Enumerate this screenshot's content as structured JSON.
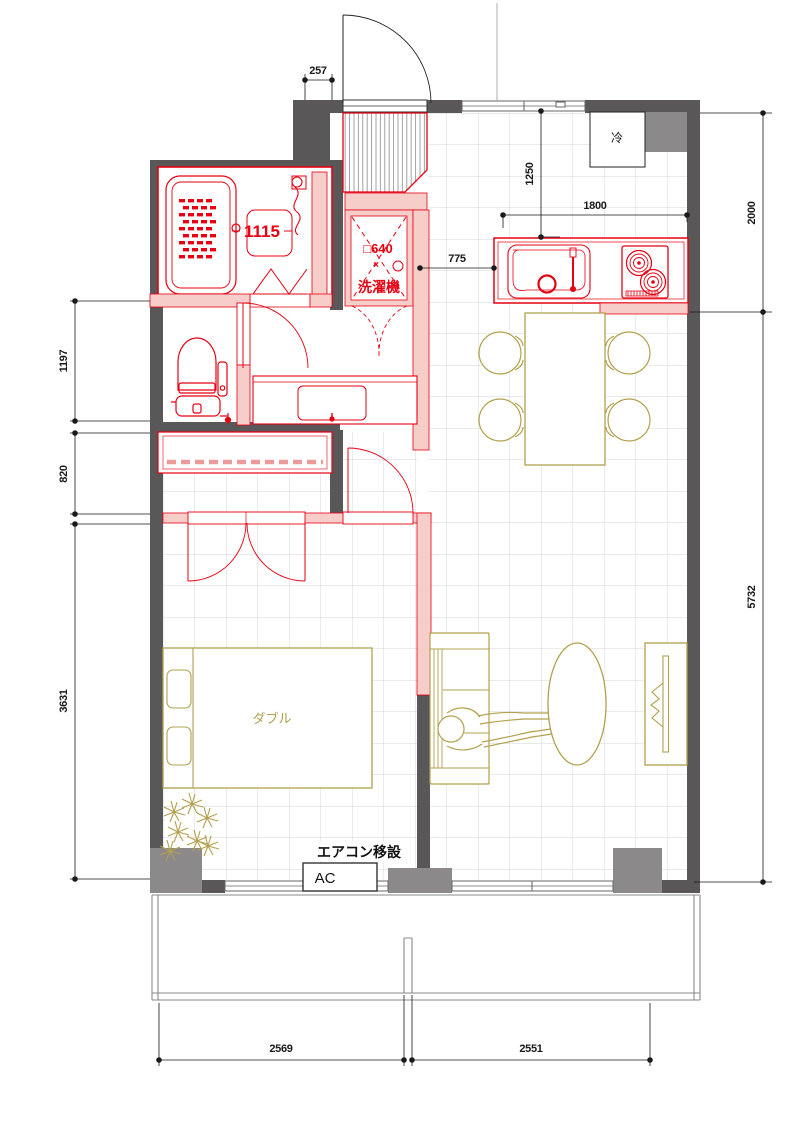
{
  "plan": {
    "title": "apartment-floor-plan",
    "labels": {
      "unit_bath_size": "1115",
      "refrigerator": "冷",
      "washer_size": "□640",
      "washer_times": "×",
      "washer": "洗濯機",
      "bed": "ダブル",
      "ac_note": "エアコン移設",
      "ac": "AC"
    },
    "dimensions": {
      "entry_offset": "257",
      "kitchen_depth": "1250",
      "kitchen_width": "1800",
      "kitchen_zone_height": "2000",
      "passage_width": "775",
      "toilet_zone_height": "1197",
      "closet_zone_height": "820",
      "bedroom_height": "3631",
      "living_height": "5732",
      "balcony_left_width": "2569",
      "balcony_right_width": "2551"
    },
    "colors": {
      "renovation_red": "#e60012",
      "renovation_pink": "#f7cdc9",
      "wall_dark": "#595757",
      "wall_gray": "#8b8989",
      "furniture_tan": "#b2a04e",
      "grid": "#c6c6c6",
      "dimension_black": "#1a1a1a"
    }
  }
}
